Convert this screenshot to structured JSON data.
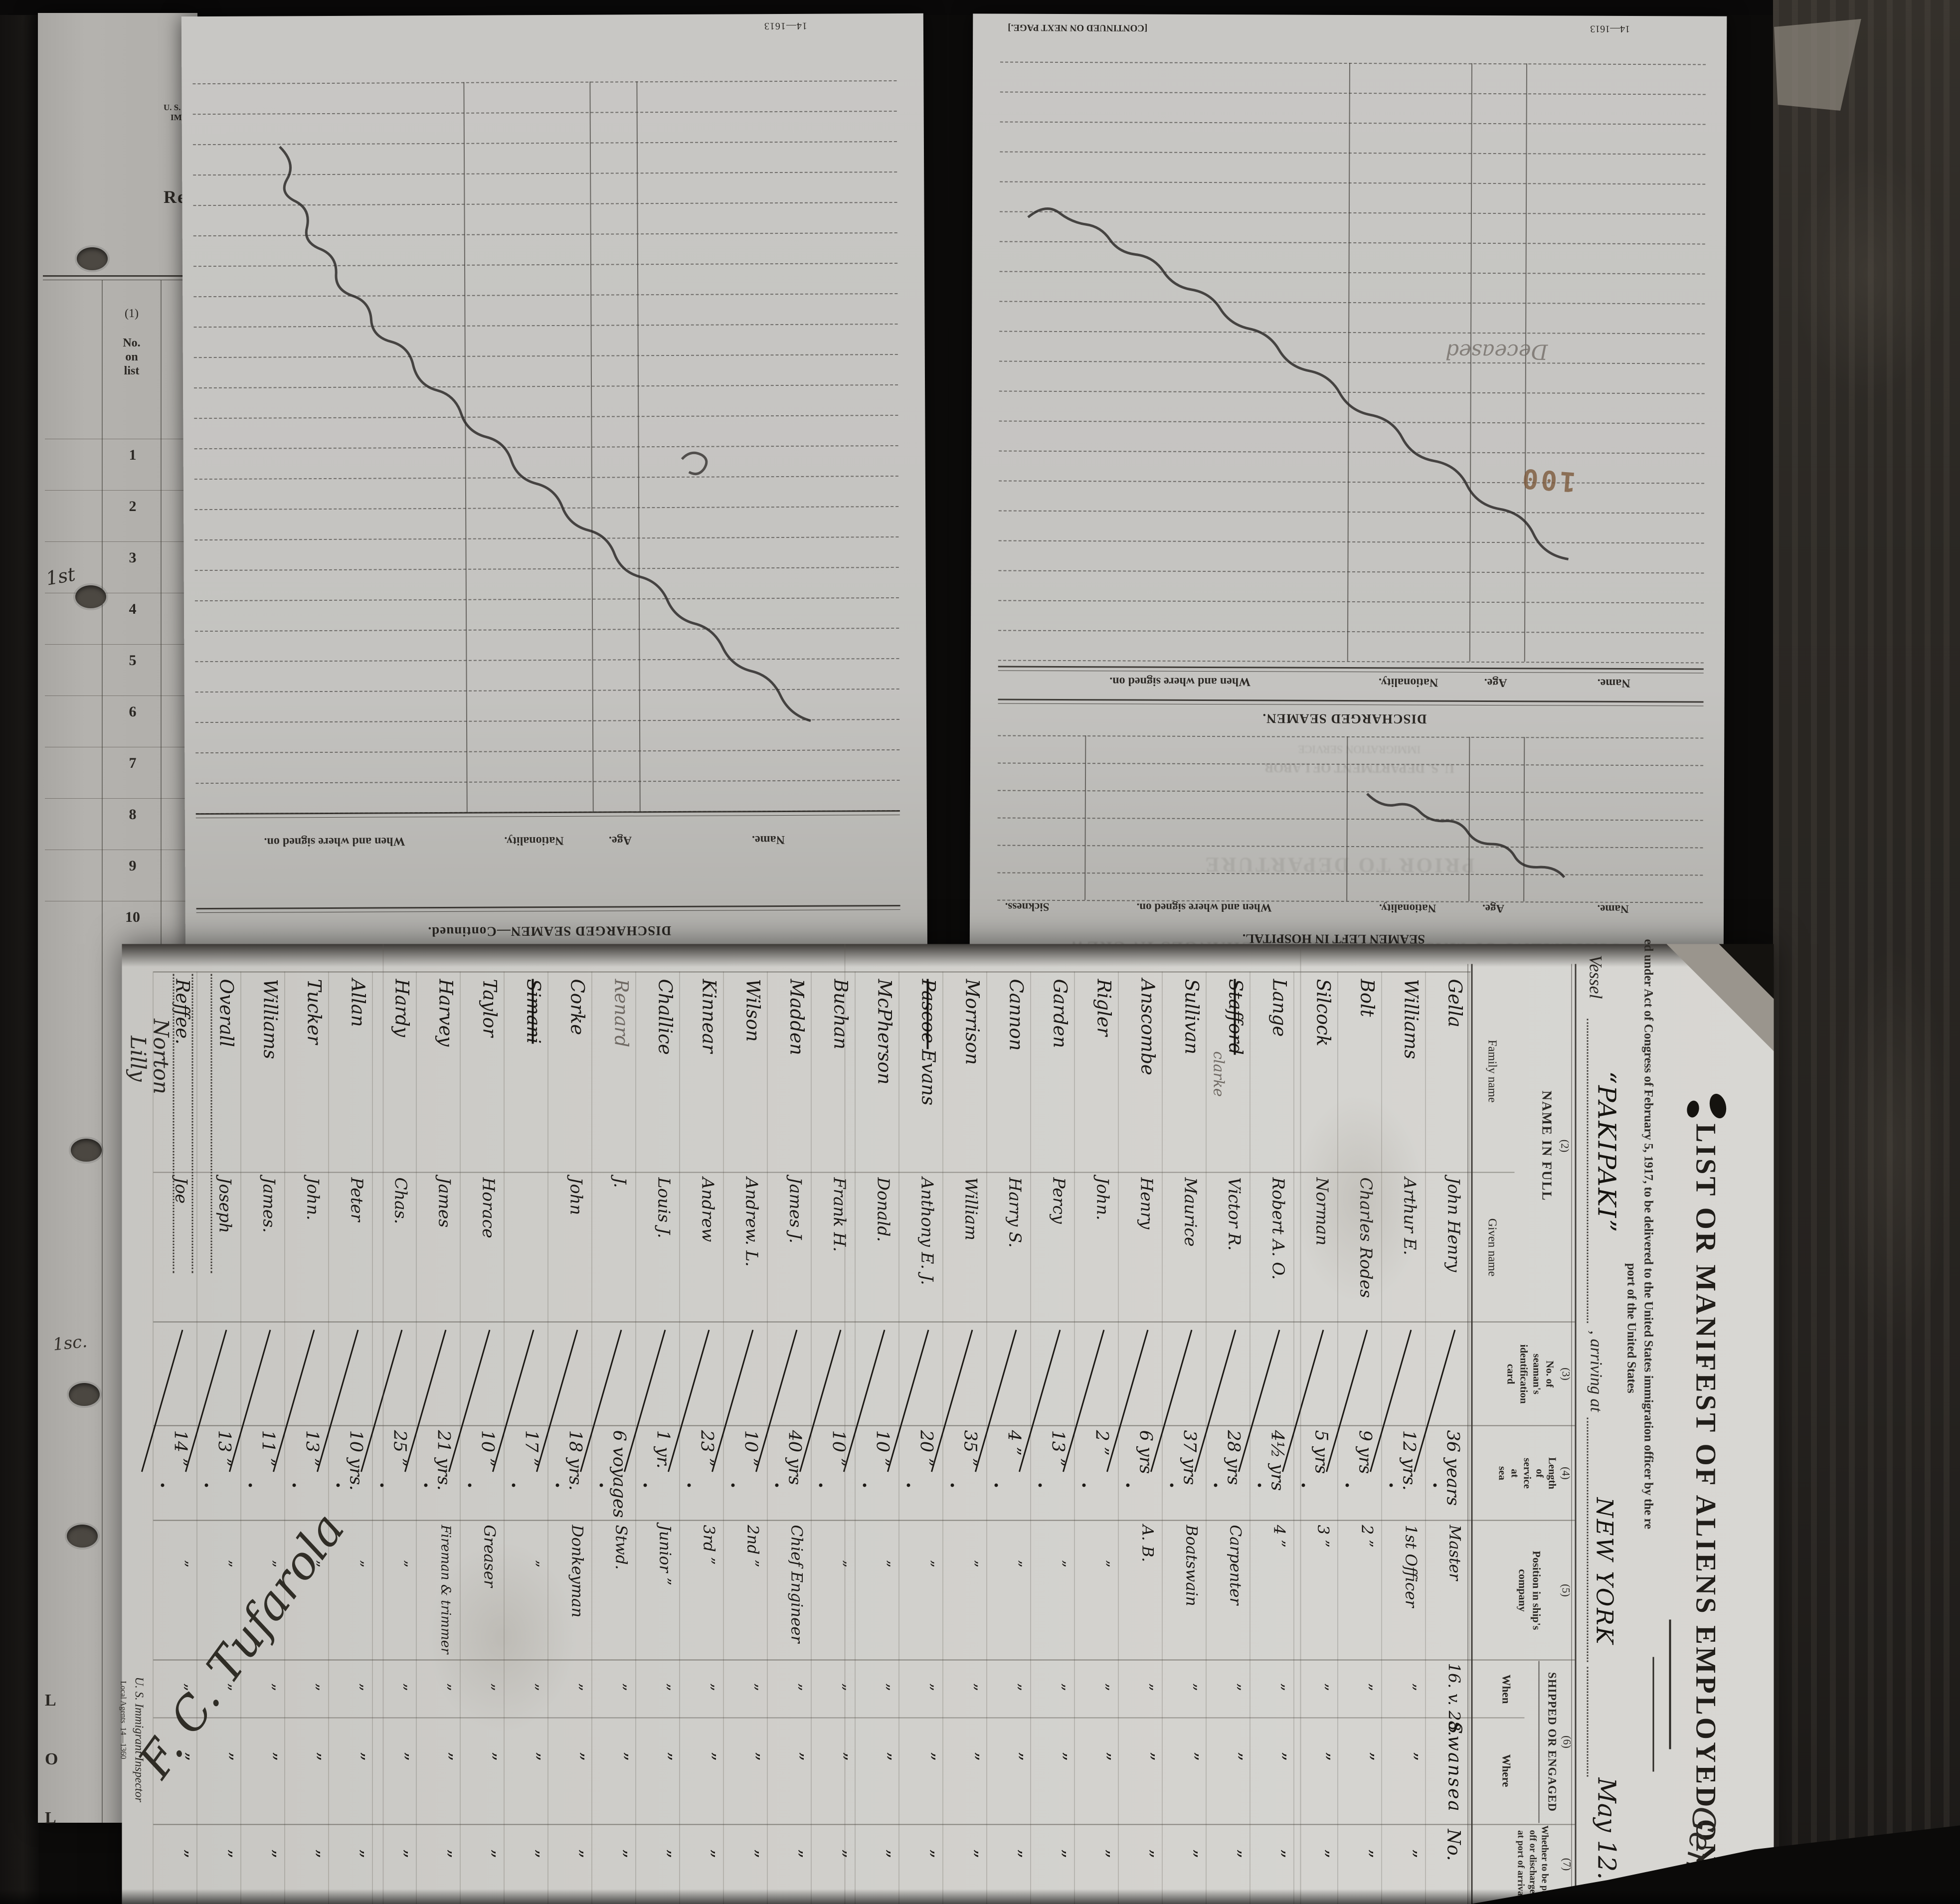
{
  "palette": {
    "background": "#0c0b0a",
    "paper_top": "#c6c5c2",
    "paper_manifest": "#d4d3cf",
    "paper_strip": "#b2b0ac",
    "ink": "#1b1815",
    "pencil": "#6e6862",
    "stamp": "#7d5a3c",
    "dark_strip": "#272420"
  },
  "left_strip": {
    "dept_line1": "U. S. DEPAR",
    "dept_line2": "IMMIGR",
    "form_word": "Requir",
    "col1_no": "(1)",
    "col1_label_1": "No.",
    "col1_label_2": "on",
    "col1_label_3": "list",
    "row_numbers": [
      "1",
      "2",
      "3",
      "4",
      "5",
      "6",
      "7",
      "8",
      "9",
      "10"
    ],
    "margin_note_top": "1st",
    "margin_note_bottom": "1sc.",
    "edge_letters": [
      "L",
      "O",
      "L"
    ]
  },
  "page_a": {
    "form_no": "14—1613",
    "title": "DISCHARGED SEAMEN—Continued.",
    "columns": [
      "When and where signed on.",
      "Nationality.",
      "Age.",
      "Name."
    ]
  },
  "page_b": {
    "continued_note": "[CONTINUED ON NEXT PAGE.]",
    "form_no": "14—1613",
    "discharged_title": "DISCHARGED SEAMEN.",
    "discharged_columns": [
      "When and where signed on.",
      "Nationality.",
      "Age.",
      "Name."
    ],
    "hospital_title": "SEAMEN LEFT IN HOSPITAL.",
    "hospital_columns": [
      "Sickness.",
      "When and where signed on.",
      "Nationality.",
      "Age.",
      "Name."
    ],
    "stamp": "100",
    "pencil_note": "Deceased",
    "ghost_lines": [
      "U. S. DEPARTMENT OF LABOR",
      "IMMIGRATION SERVICE",
      "PRIOR TO DEPARTURE",
      "STATEMENT OF MASTER REGARDING CHANGES IN CREW"
    ]
  },
  "manifest": {
    "title": "LIST OR MANIFEST OF ALIENS EMPLOYED ON THE VESSEL",
    "subtitle": "ed under Act of Congress of February 5, 1917, to be delivered to the United States immigration officer by the re",
    "subtitle2": "port of the United States",
    "vessel_label": "Vessel",
    "vessel_name": "“PAKIPAKI”",
    "arriving_label": ", arriving at",
    "port": "NEW YORK",
    "date": "May 12. 192",
    "columns": {
      "c2_no": "(2)",
      "c2": "NAME IN FULL",
      "family": "Family name",
      "given": "Given name",
      "c3_no": "(3)",
      "c3_lines": [
        "No. of",
        "seaman's",
        "identification",
        "card"
      ],
      "c4_no": "(4)",
      "c4_lines": [
        "Length",
        "of",
        "service",
        "at",
        "sea"
      ],
      "c5_no": "(5)",
      "c5_lines": [
        "Position in ship's",
        "company"
      ],
      "c6_no": "(6)",
      "c6": "SHIPPED OR ENGAGED",
      "when": "When",
      "where": "Where",
      "c7_no": "(7)",
      "c7_lines": [
        "Whether to be paid",
        "off or discharged",
        "at port of arrival"
      ]
    },
    "rows": [
      {
        "family": "Gella",
        "given": "John Henry",
        "service": "36 years",
        "position": "Master",
        "when": "16. v. 28.",
        "where": "Swansea",
        "paid": "No."
      },
      {
        "family": "Williams",
        "given": "Arthur E.",
        "service": "12 yrs.",
        "position": "1st Officer",
        "when": "”",
        "where": "”",
        "paid": "”"
      },
      {
        "family": "Bolt",
        "given": "Charles Rodes",
        "service": "9 yrs",
        "position": "2 ”",
        "when": "”",
        "where": "”",
        "paid": "”"
      },
      {
        "family": "Silcock",
        "given": "Norman",
        "service": "5 yrs",
        "position": "3 ”",
        "when": "”",
        "where": "”",
        "paid": "”"
      },
      {
        "family": "Lange",
        "given": "Robert A. O.",
        "service": "4½ yrs",
        "position": "4 ”",
        "when": "”",
        "where": "”",
        "paid": "”"
      },
      {
        "family": "Stafford",
        "family_struck": true,
        "family_note": "clarke",
        "given": "Victor R.",
        "service": "28 yrs",
        "position": "Carpenter",
        "when": "”",
        "where": "”",
        "paid": "”"
      },
      {
        "family": "Sullivan",
        "given": "Maurice",
        "service": "37 yrs",
        "position": "Boatswain",
        "when": "”",
        "where": "”",
        "paid": "”"
      },
      {
        "family": "Anscombe",
        "given": "Henry",
        "service": "6 yrs",
        "position": "A. B.",
        "when": "”",
        "where": "”",
        "paid": "”"
      },
      {
        "family": "Rigler",
        "given": "John.",
        "service": "2 ”",
        "position": "”",
        "when": "”",
        "where": "”",
        "paid": "”"
      },
      {
        "family": "Garden",
        "given": "Percy",
        "service": "13 ”",
        "position": "”",
        "when": "”",
        "where": "”",
        "paid": "”"
      },
      {
        "family": "Cannon",
        "given": "Harry S.",
        "service": "4 ”",
        "position": "”",
        "when": "”",
        "where": "”",
        "paid": "”"
      },
      {
        "family": "Morrison",
        "given": "William",
        "service": "35 ”",
        "position": "”",
        "when": "”",
        "where": "”",
        "paid": "”"
      },
      {
        "family": "Evans",
        "family_prefix": "Pascoe",
        "given": "Anthony E. J.",
        "service": "20 ”",
        "position": "”",
        "when": "”",
        "where": "”",
        "paid": "”"
      },
      {
        "family": "McPherson",
        "given": "Donald.",
        "service": "10 ”",
        "position": "”",
        "when": "”",
        "where": "”",
        "paid": "”"
      },
      {
        "family": "Buchan",
        "given": "Frank H.",
        "service": "10 ”",
        "position": "”",
        "when": "”",
        "where": "”",
        "paid": "”"
      },
      {
        "family": "Madden",
        "given": "James J.",
        "service": "40 yrs",
        "position": "Chief Engineer",
        "when": "”",
        "where": "”",
        "paid": "”"
      },
      {
        "family": "Wilson",
        "given": "Andrew. L.",
        "service": "10 ”",
        "position": "2nd ”",
        "when": "”",
        "where": "”",
        "paid": "”"
      },
      {
        "family": "Kinnear",
        "given": "Andrew",
        "service": "23 ”",
        "position": "3rd ”",
        "when": "”",
        "where": "”",
        "paid": "”"
      },
      {
        "family": "Challice",
        "given": "Louis J.",
        "service": "1 yr.",
        "position": "Junior ”",
        "when": "”",
        "where": "”",
        "paid": "”"
      },
      {
        "family": "Renard",
        "family_pencil": true,
        "given": "J.",
        "service": "6 voyages",
        "position": "Stwd.",
        "when": "”",
        "where": "”",
        "paid": "”"
      },
      {
        "family": "Corke",
        "given": "John",
        "service": "18 yrs.",
        "position": "Donkeyman",
        "when": "”",
        "where": "”",
        "paid": "”"
      },
      {
        "family": "Simani",
        "family_struck": true,
        "given": "",
        "service": "17 ”",
        "position": "”",
        "when": "”",
        "where": "”",
        "paid": "”"
      },
      {
        "family": "Taylor",
        "given": "Horace",
        "service": "10 ”",
        "position": "Greaser",
        "when": "”",
        "where": "”",
        "paid": "”"
      },
      {
        "family": "Harvey",
        "given": "James",
        "service": "21 yrs.",
        "position": "Fireman & trimmer",
        "when": "”",
        "where": "”",
        "paid": "”"
      },
      {
        "family": "Hardy",
        "given": "Chas.",
        "service": "25 ”",
        "position": "”",
        "when": "”",
        "where": "”",
        "paid": "”"
      },
      {
        "family": "Allan",
        "given": "Peter",
        "service": "10 yrs.",
        "position": "”",
        "when": "”",
        "where": "”",
        "paid": "”"
      },
      {
        "family": "Tucker",
        "given": "John.",
        "service": "13 ”",
        "position": "”",
        "when": "”",
        "where": "”",
        "paid": "”"
      },
      {
        "family": "Williams",
        "given": "James.",
        "service": "11 ”",
        "position": "”",
        "when": "”",
        "where": "”",
        "paid": "”"
      },
      {
        "family": "Overall",
        "given": "Joseph",
        "service": "13 ”",
        "position": "”",
        "when": "”",
        "where": "”",
        "paid": "”"
      },
      {
        "family": "Reffee.",
        "given": "Joe",
        "service": "14 ”",
        "position": "”",
        "when": "”",
        "where": "”",
        "paid": "”"
      }
    ],
    "margin_agent_1": "Norton",
    "margin_agent_2": "Lilly",
    "signature": "F. C. Tufarola",
    "inspector_label": "U. S. Immigrant Inspector",
    "agents_label": "Local Agents",
    "agents_form_no": "14—1360",
    "corner_note": "Gen"
  }
}
